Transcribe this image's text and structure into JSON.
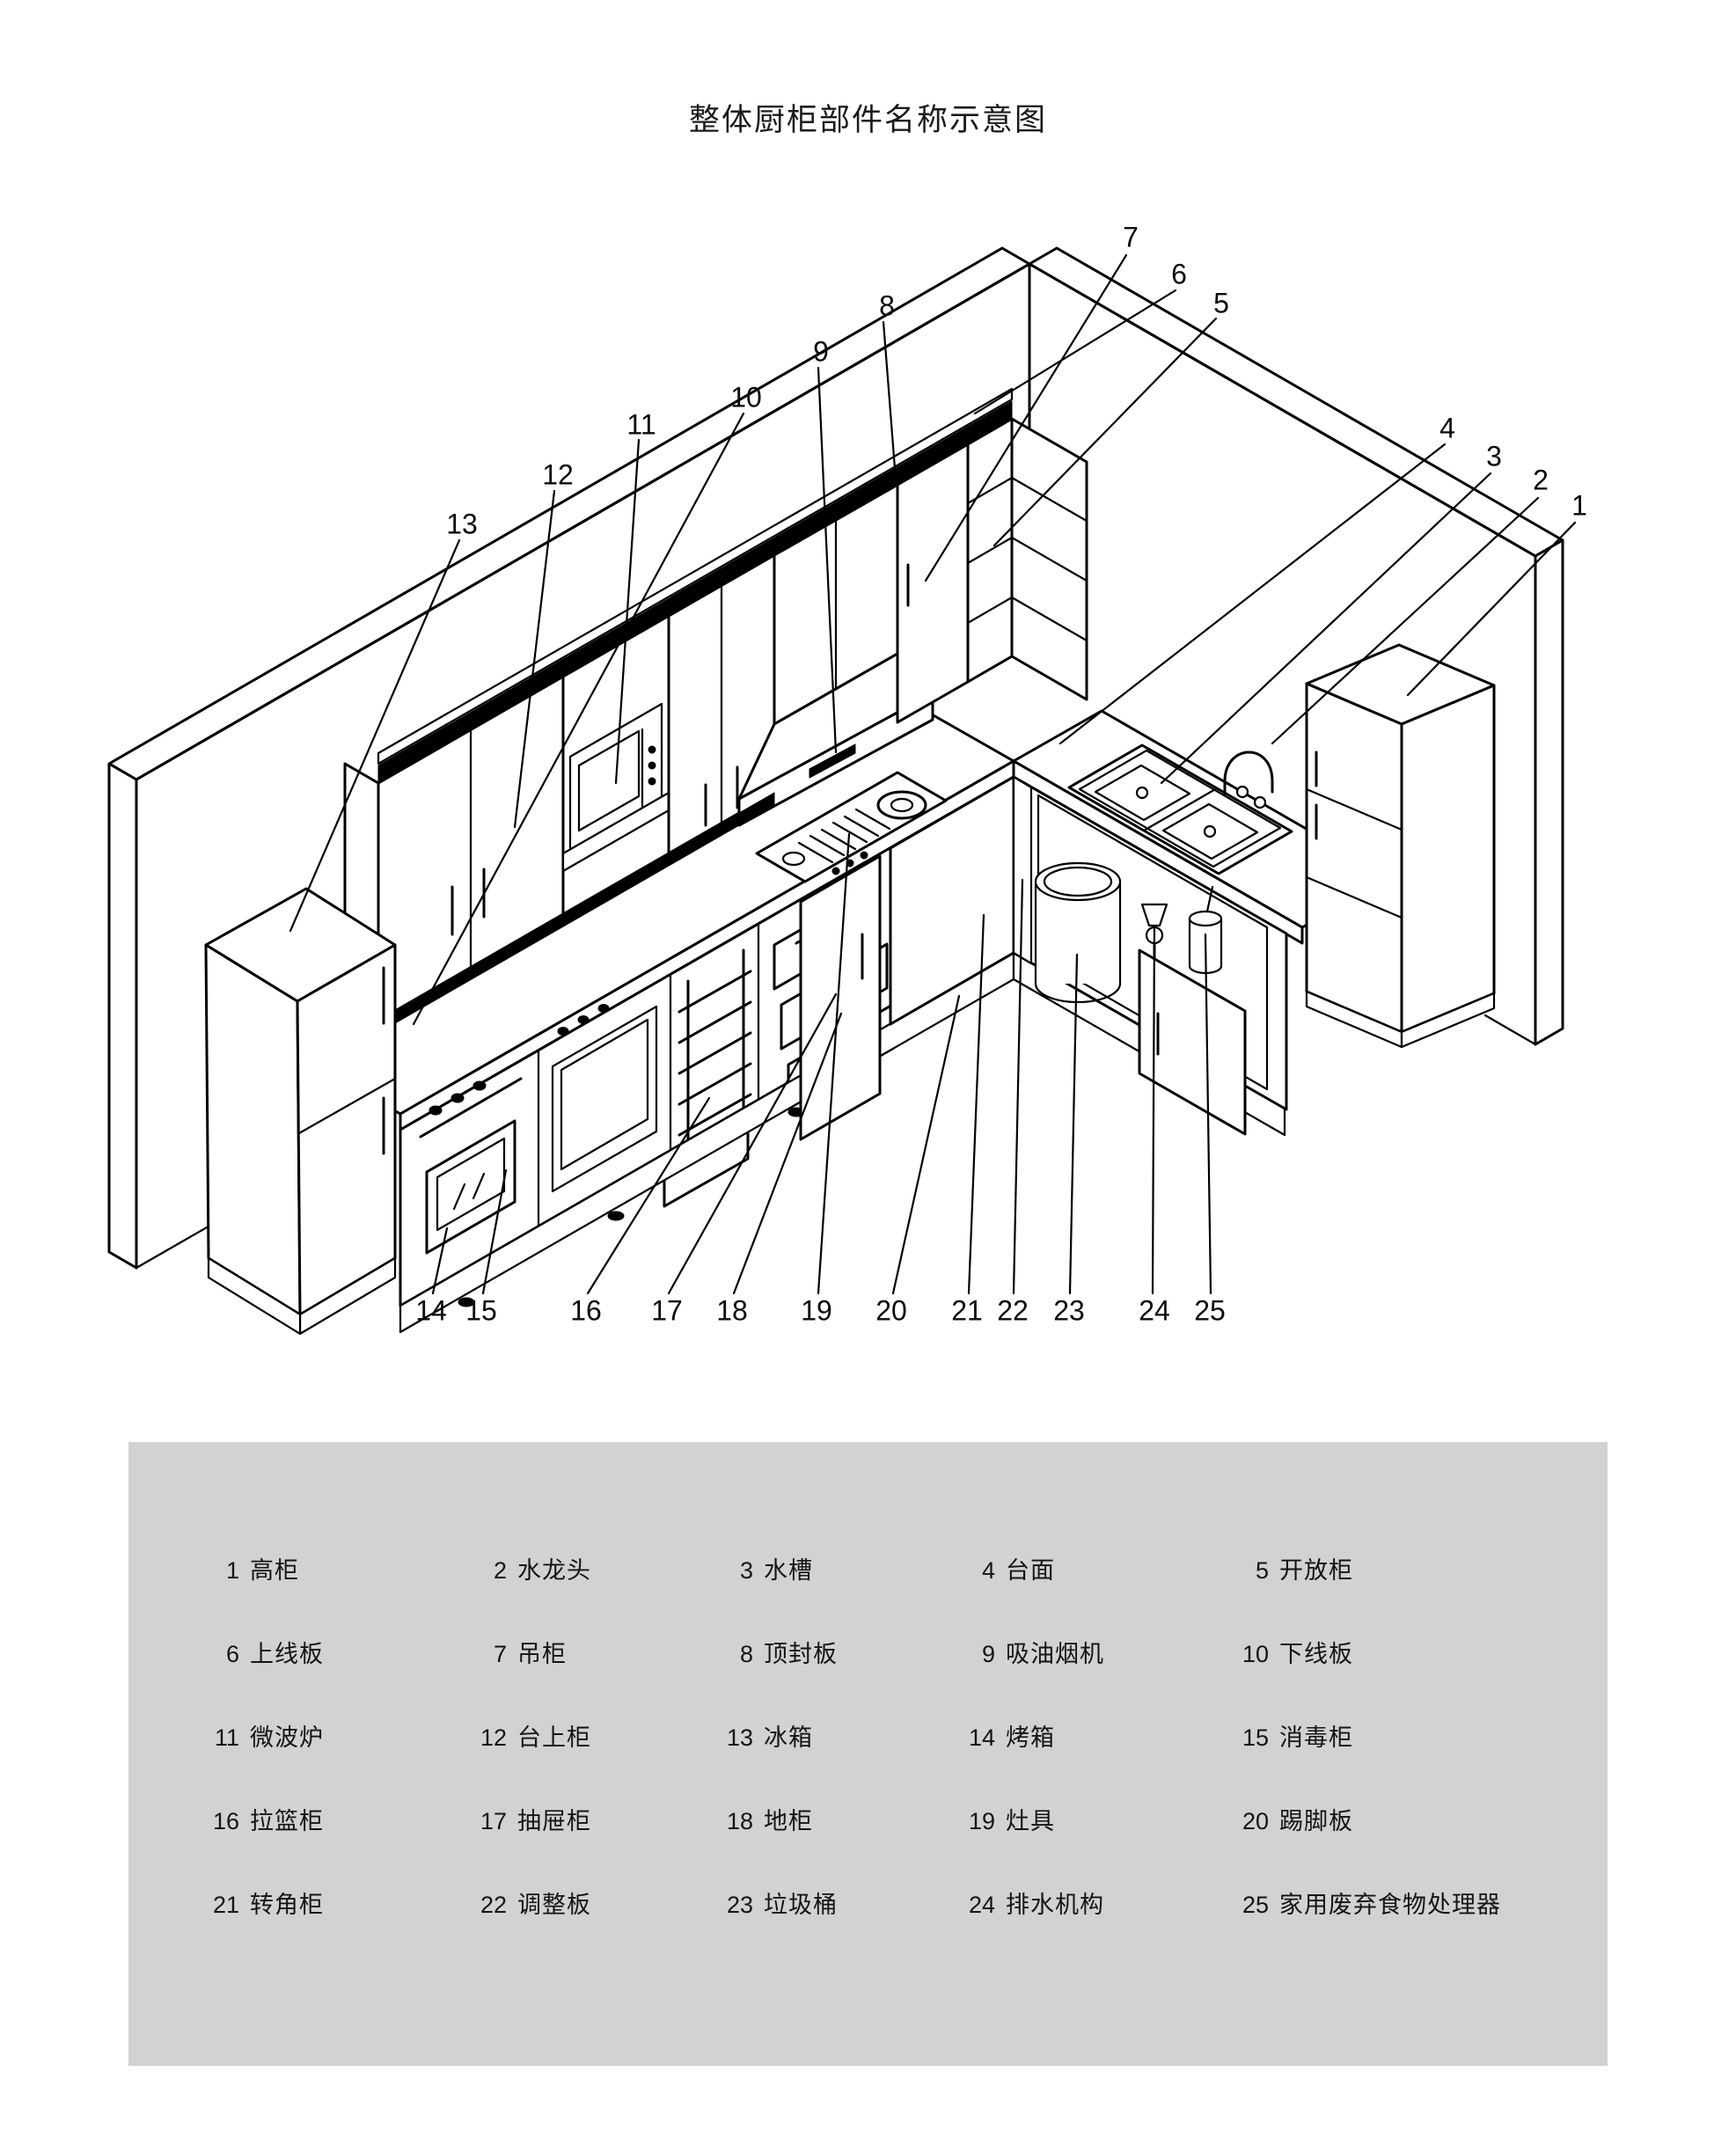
{
  "title": "整体厨柜部件名称示意图",
  "colors": {
    "background": "#ffffff",
    "line": "#000000",
    "legend_bg": "#d2d2d2"
  },
  "diagram": {
    "type": "isometric-kitchen-parts-diagram",
    "callouts": [
      "1",
      "2",
      "3",
      "4",
      "5",
      "6",
      "7",
      "8",
      "9",
      "10",
      "11",
      "12",
      "13",
      "14",
      "15",
      "16",
      "17",
      "18",
      "19",
      "20",
      "21",
      "22",
      "23",
      "24",
      "25"
    ]
  },
  "legend": {
    "items": [
      {
        "num": "1",
        "name": "高柜"
      },
      {
        "num": "2",
        "name": "水龙头"
      },
      {
        "num": "3",
        "name": "水槽"
      },
      {
        "num": "4",
        "name": "台面"
      },
      {
        "num": "5",
        "name": "开放柜"
      },
      {
        "num": "6",
        "name": "上线板"
      },
      {
        "num": "7",
        "name": "吊柜"
      },
      {
        "num": "8",
        "name": "顶封板"
      },
      {
        "num": "9",
        "name": "吸油烟机"
      },
      {
        "num": "10",
        "name": "下线板"
      },
      {
        "num": "11",
        "name": "微波炉"
      },
      {
        "num": "12",
        "name": "台上柜"
      },
      {
        "num": "13",
        "name": "冰箱"
      },
      {
        "num": "14",
        "name": "烤箱"
      },
      {
        "num": "15",
        "name": "消毒柜"
      },
      {
        "num": "16",
        "name": "拉篮柜"
      },
      {
        "num": "17",
        "name": "抽屉柜"
      },
      {
        "num": "18",
        "name": "地柜"
      },
      {
        "num": "19",
        "name": "灶具"
      },
      {
        "num": "20",
        "name": "踢脚板"
      },
      {
        "num": "21",
        "name": "转角柜"
      },
      {
        "num": "22",
        "name": "调整板"
      },
      {
        "num": "23",
        "name": "垃圾桶"
      },
      {
        "num": "24",
        "name": "排水机构"
      },
      {
        "num": "25",
        "name": "家用废弃食物处理器"
      }
    ]
  }
}
